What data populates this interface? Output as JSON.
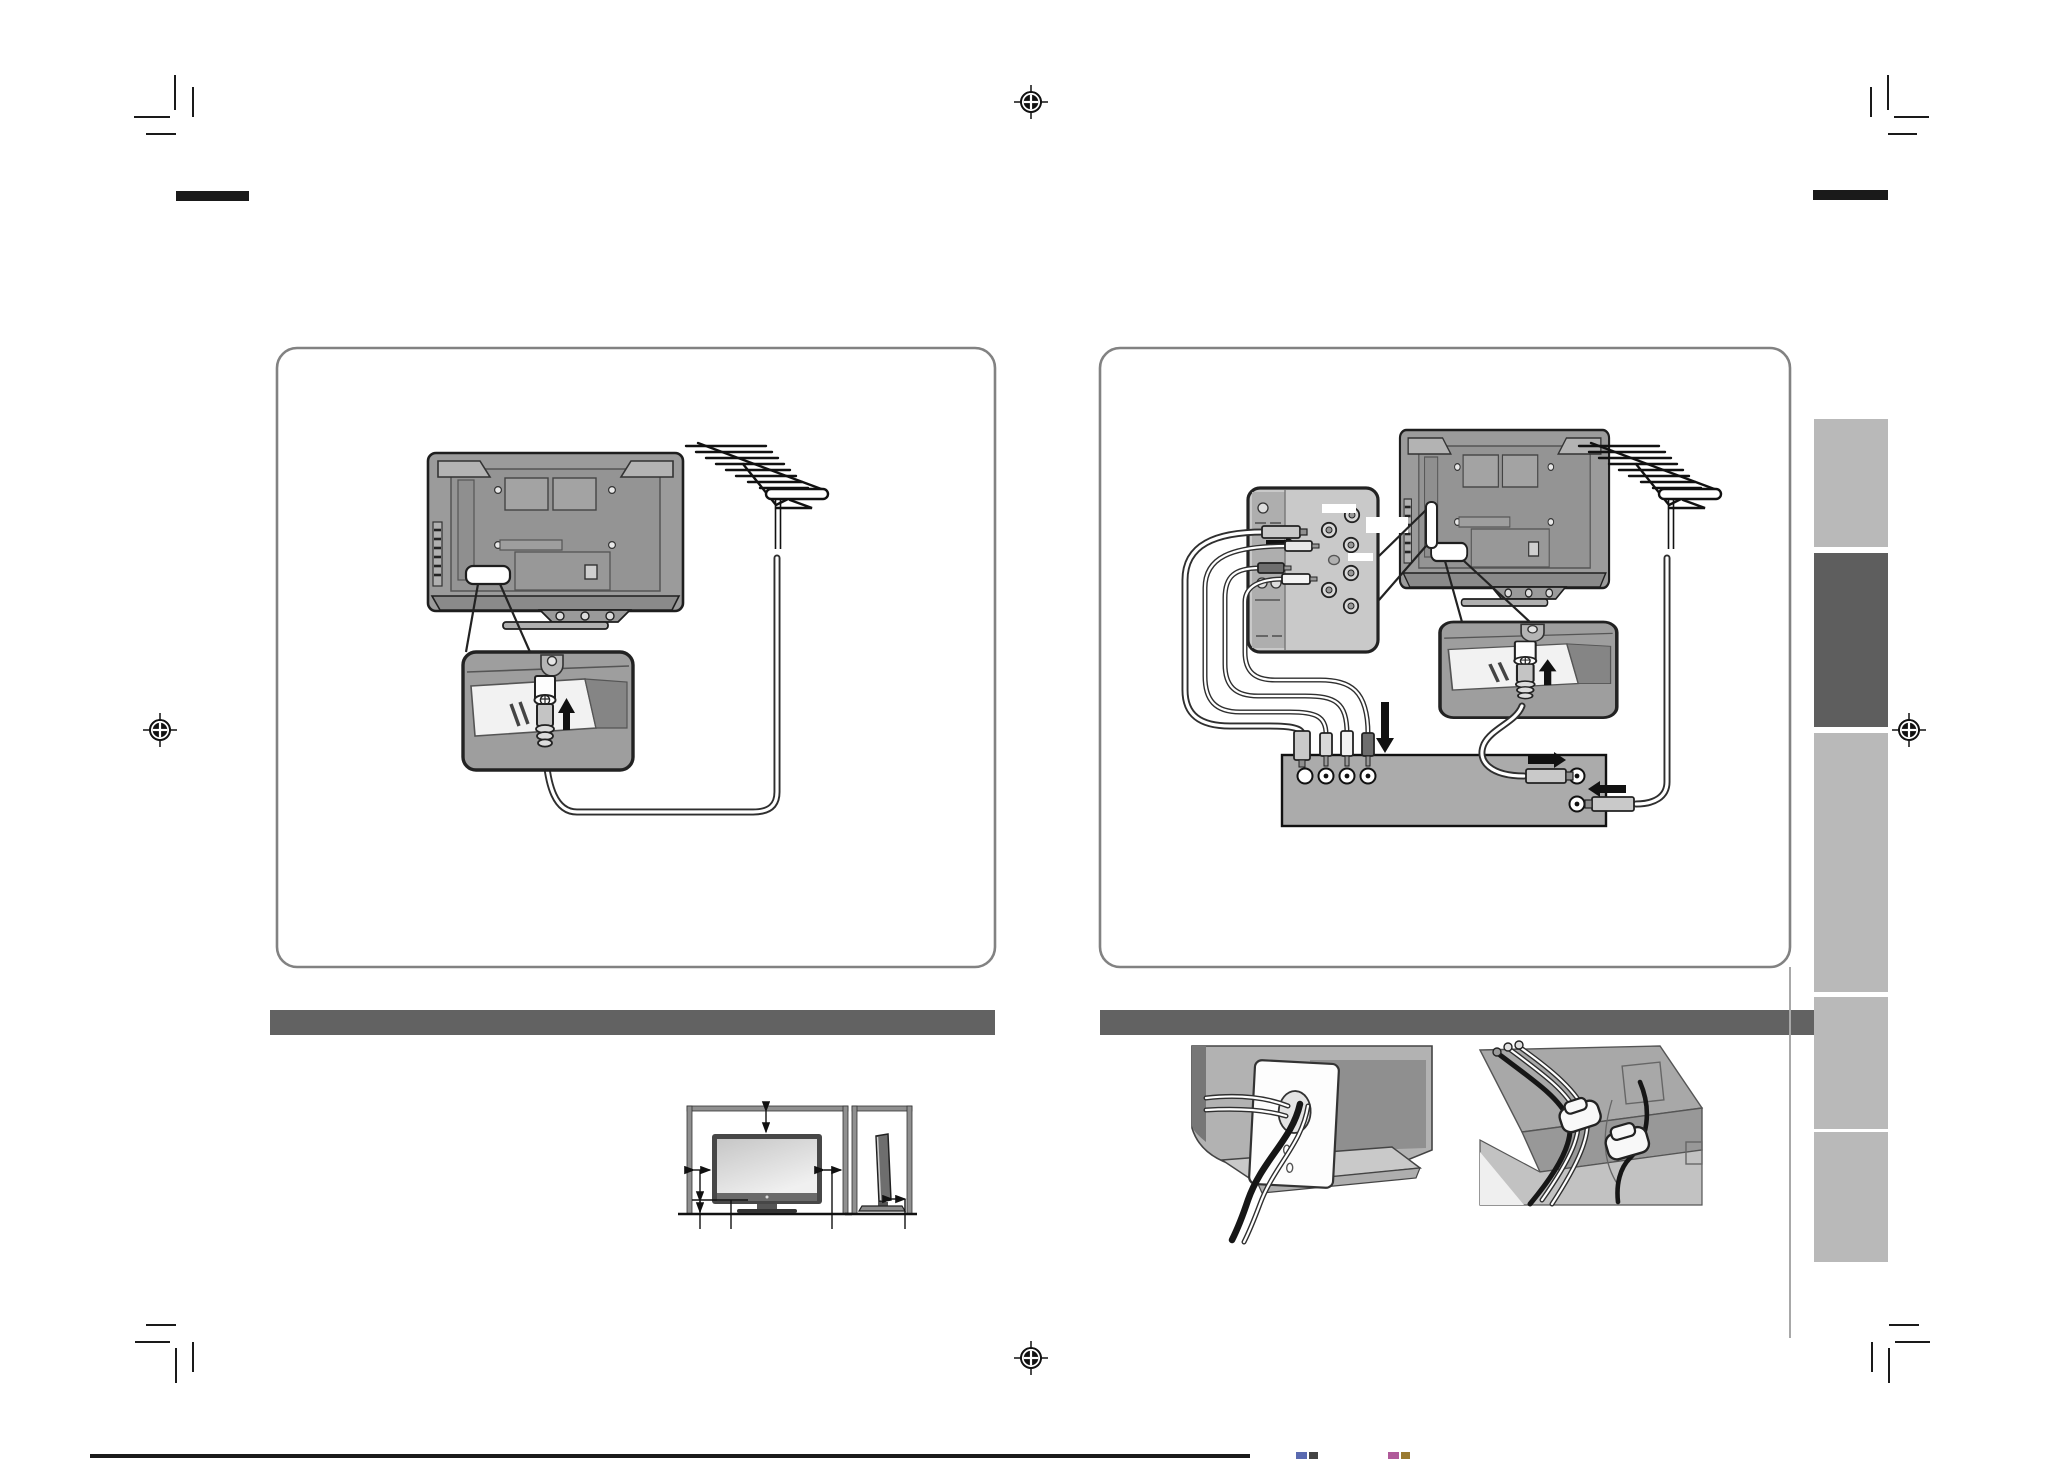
{
  "document": {
    "kind": "instruction-manual-page-proof",
    "visible_text": [],
    "note": "illustration-only prepress page; no legible text rendered in pixels"
  },
  "palette": {
    "page_bg": "#ffffff",
    "ink": "#1a1a1a",
    "outline": "#222222",
    "box_border": "#828282",
    "section_bar": "#626262",
    "tab_light": "#b9b9b9",
    "tab_dark": "#5e5e5e",
    "tv_gray": "#9b9b9b",
    "tv_gray_dark": "#878787",
    "panel_gray": "#c9c9c9",
    "strip_gray": "#aeaeae",
    "stb_gray": "#ababab",
    "inset_gray": "#9e9e9e",
    "photo_gray": "#b2b2b2",
    "faint_line": "#a8a8a8",
    "white": "#ffffff"
  },
  "printer_marks": {
    "registration_targets": [
      {
        "id": "top-center",
        "x": 1031,
        "y": 102
      },
      {
        "id": "left-middle",
        "x": 160,
        "y": 730
      },
      {
        "id": "right-middle",
        "x": 1909,
        "y": 730
      },
      {
        "id": "bottom-center",
        "x": 1031,
        "y": 1358
      }
    ],
    "corner_crop_marks": [
      "top-left",
      "top-right",
      "bottom-left",
      "bottom-right"
    ],
    "black_bars": [
      "top-left",
      "top-right"
    ],
    "bottom_rule": {
      "x": 90,
      "y": 1454,
      "w": 1160,
      "h": 4
    }
  },
  "figures": {
    "left_panel": {
      "caption": "",
      "parts": [
        "tv-rear-view",
        "antenna-terminal-label",
        "antenna-jack-inset",
        "coaxial-cable",
        "outdoor-antenna"
      ]
    },
    "right_panel": {
      "caption": "",
      "parts": [
        "av-terminal-panel",
        "av-plugs",
        "tv-rear-view",
        "antenna-jack-inset",
        "set-top-box",
        "outdoor-antenna",
        "coaxial-cables"
      ]
    },
    "section_bars": [
      {
        "id": "left-section-bar"
      },
      {
        "id": "right-section-bar"
      }
    ],
    "clearance_diagram": {
      "views": [
        "front",
        "side"
      ]
    },
    "cable_illustrations": [
      {
        "id": "stand-cable-cover"
      },
      {
        "id": "cable-clamps"
      }
    ]
  },
  "side_tabs": [
    {
      "index": 1,
      "tone": "light"
    },
    {
      "index": 2,
      "tone": "dark"
    },
    {
      "index": 3,
      "tone": "light"
    },
    {
      "index": 4,
      "tone": "light"
    },
    {
      "index": 5,
      "tone": "light"
    }
  ]
}
